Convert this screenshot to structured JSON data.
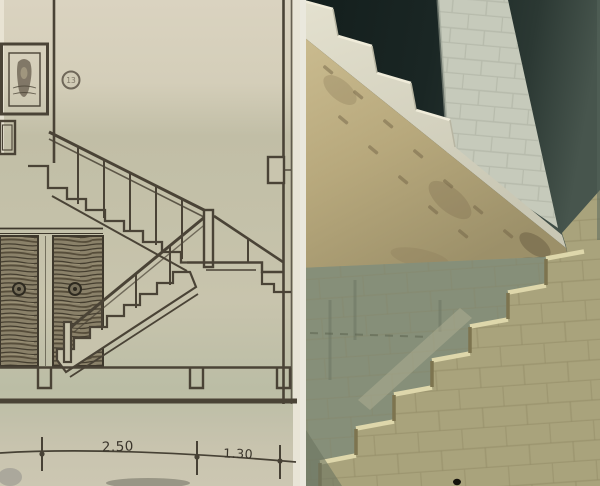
{
  "drawing": {
    "dimension_labels": [
      "2.50",
      "1.30"
    ],
    "detail_marker": "13",
    "paper_color": "#cfcab4",
    "ink_color": "#4a4336",
    "wood_color": "#8a8169"
  },
  "photo": {
    "opening_color": "#16211f",
    "pier_color": "#c6cabb",
    "slab_color": "#b7a87c",
    "wall_color": "#9d9a79",
    "step_highlight_color": "#ded7ab"
  }
}
